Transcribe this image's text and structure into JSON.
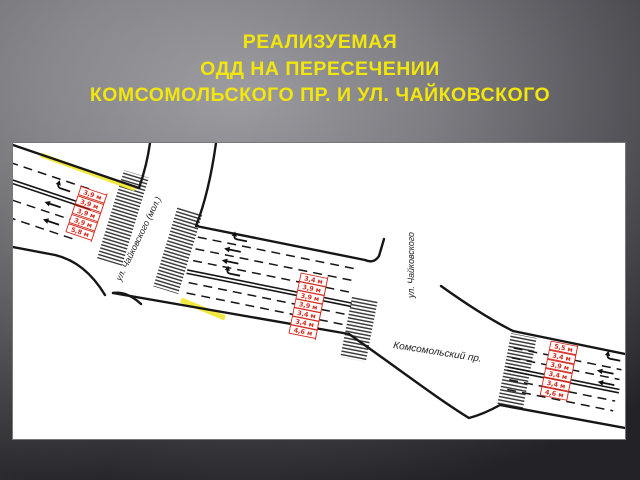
{
  "title": {
    "line1": "РЕАЛИЗУЕМАЯ",
    "line2": "ОДД НА ПЕРЕСЕЧЕНИИ",
    "line3": "КОМСОМОЛЬСКОГО ПР. И УЛ. ЧАЙКОВСКОГО",
    "color": "#f2e60a"
  },
  "diagram": {
    "street_labels": {
      "left_cross": "ул. Чайковского (мол.)",
      "right_cross": "ул. Чайковского",
      "main": "Комсомольский пр."
    },
    "lane_widths": {
      "west_section": [
        "3,9 м",
        "3,9 м",
        "3,9 м",
        "3,9 м",
        "5,8 м"
      ],
      "center_section": [
        "3,4 м",
        "3,9 м",
        "3,9 м",
        "3,9 м",
        "3,4 м",
        "3,4 м",
        "4,6 м"
      ],
      "east_section": [
        "5,5 м",
        "3,4 м",
        "3,9 м",
        "3,4 м",
        "3,4 м",
        "4,6 м"
      ]
    },
    "dimension_color": "#d32b1f",
    "marking_colors": {
      "yellow_line": "#f3e93e",
      "road_line": "#161616"
    },
    "panel_background": "#ffffff"
  }
}
